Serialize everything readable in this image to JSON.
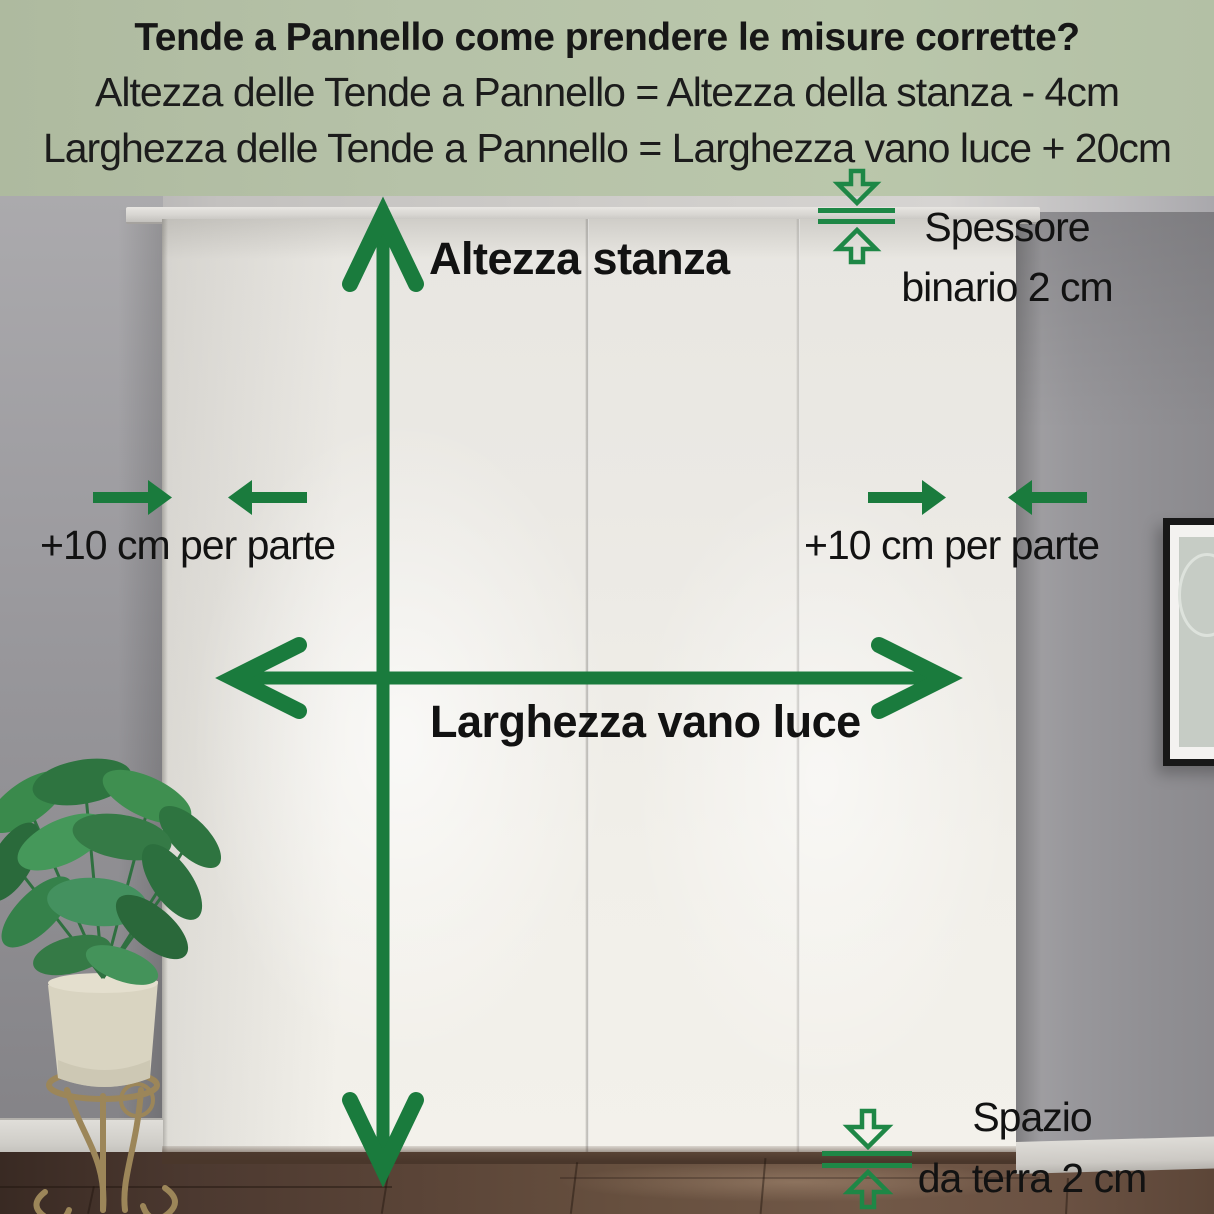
{
  "header": {
    "bg_color": "#b6c2a8",
    "text_color": "#171717",
    "title": "Tende a Pannello come prendere le misure corrette?",
    "formula_height": "Altezza delle Tende a Pannello = Altezza della stanza - 4cm",
    "formula_width": "Larghezza delle Tende a Pannello = Larghezza vano luce + 20cm"
  },
  "annotations": {
    "arrow_color": "#1a7b3d",
    "indicator_color": "#1e8746",
    "label_color": "#121212",
    "room_height_label": "Altezza stanza",
    "opening_width_label": "Larghezza vano luce",
    "side_allowance_left_label": "+10 cm per parte",
    "side_allowance_right_label": "+10 cm per parte",
    "track_thickness_label_line1": "Spessore",
    "track_thickness_label_line2": "binario 2 cm",
    "floor_gap_label_line1": "Spazio",
    "floor_gap_label_line2": "da terra 2 cm"
  },
  "icons": {
    "vertical_double_arrow": "up-down measurement arrow",
    "horizontal_double_arrow": "left-right measurement arrow",
    "inward_arrows_left": "two arrows pointing inward",
    "inward_arrows_right": "two arrows pointing inward",
    "track_thickness_indicator": "hollow down/up arrows with two bars",
    "floor_gap_indicator": "hollow down/up arrows with two bars"
  },
  "scene": {
    "curtain_color": "#efede8",
    "wall_color": "#939296",
    "floor_color": "#5f4839",
    "plant": "potted calathea on metal stand",
    "picture_frame": "black framed print on right wall"
  }
}
